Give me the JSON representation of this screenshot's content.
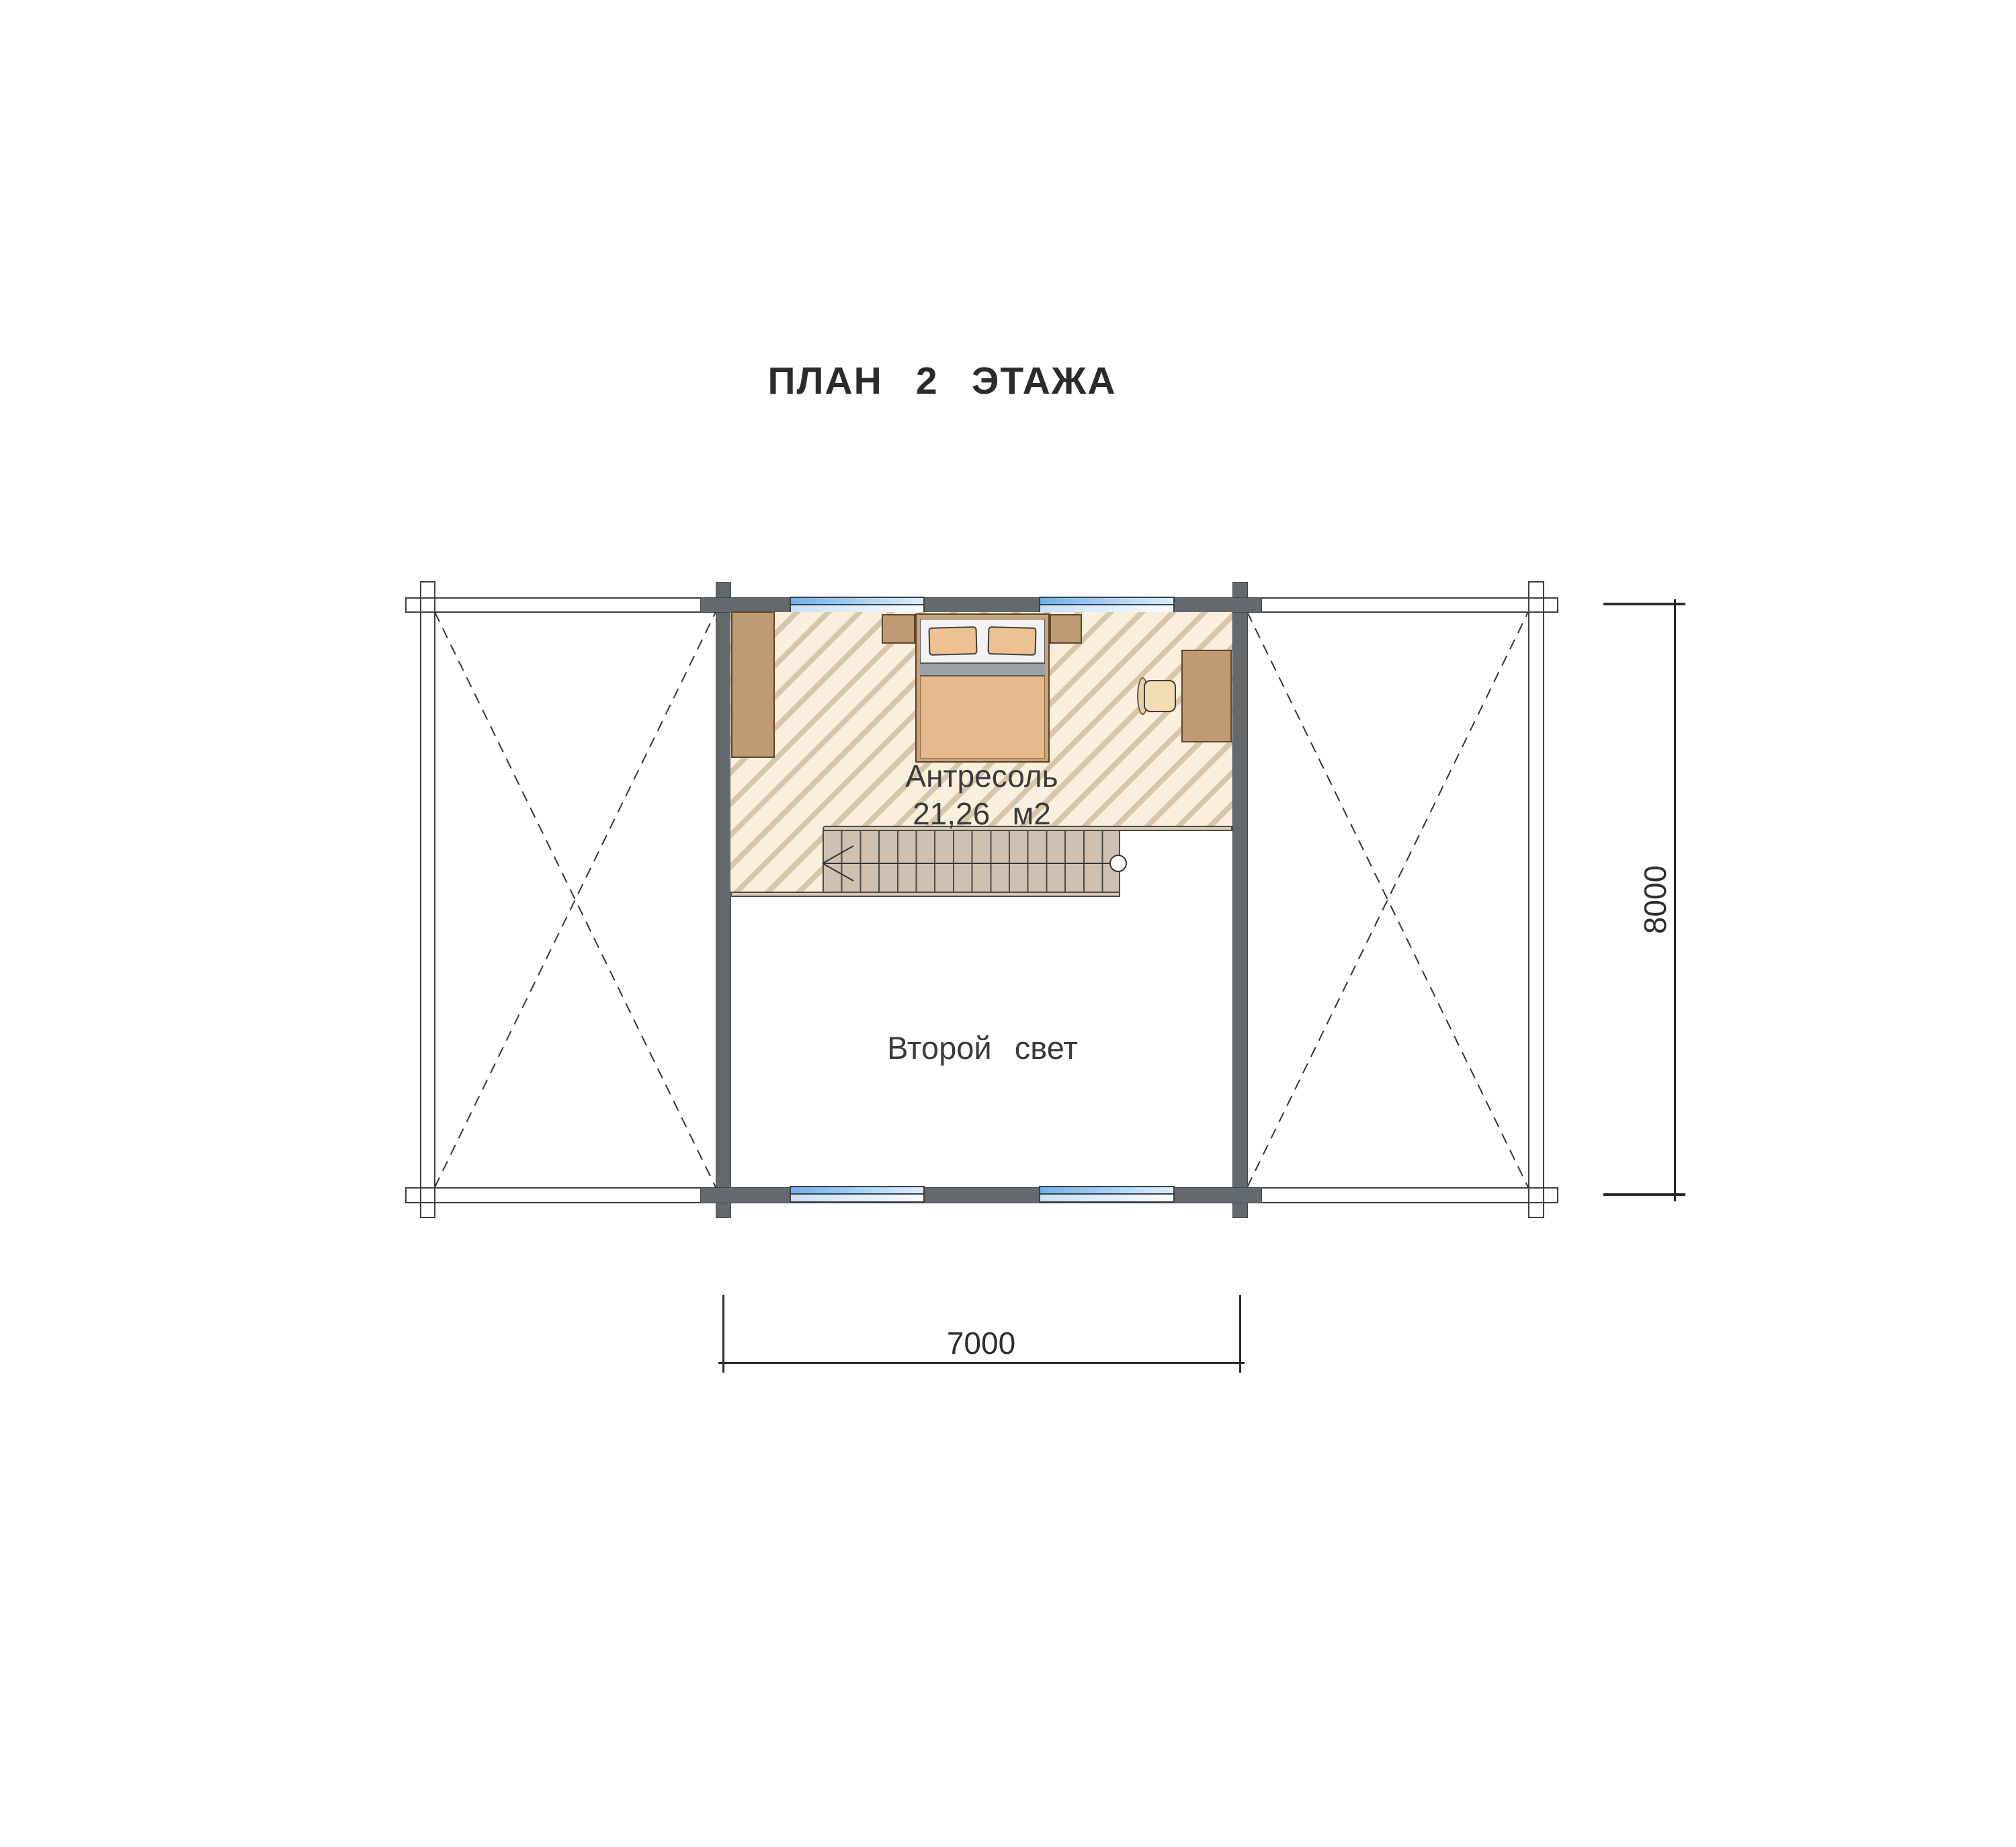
{
  "title": "ПЛАН 2 ЭТАЖА",
  "rooms": {
    "mezzanine": {
      "name": "Антресоль",
      "area": "21,26 м2"
    },
    "void": {
      "name": "Второй свет"
    }
  },
  "dims": {
    "width": "7000",
    "height": "8000"
  },
  "stairs": {
    "treads": 16,
    "direction": "left"
  },
  "colors": {
    "wall": "#64696e",
    "floor_base": "#faeedd",
    "floor_stripe": "#d8c6ab",
    "furn": "#bf9b74",
    "blanket": "#e7b98c",
    "pillow": "#edc192",
    "grayband": "#9aa1a9",
    "winblue": "#6fb0e8",
    "winlight": "#dcedfb",
    "stairs": "#cfc0b0",
    "fascia": "#d9c8b4",
    "text": "#2e2e2e"
  }
}
